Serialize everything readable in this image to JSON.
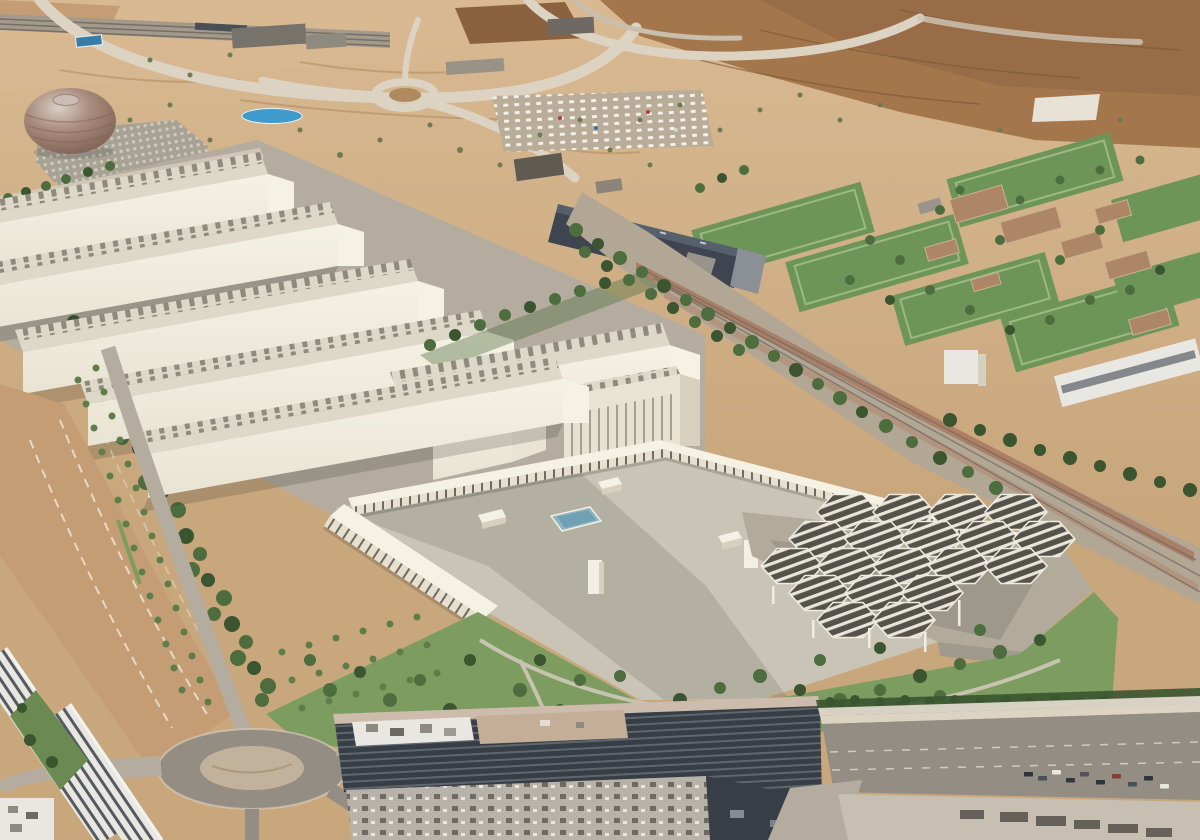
{
  "scene": {
    "title": "Aerial 3D rendering of a film-studio campus beside sports training fields",
    "soundstage_count": 5,
    "hexagon_canopy_count": 19,
    "soccer_field_count": 7
  },
  "palette": {
    "terrain-tan": "#c9a77d",
    "terrain-light": "#d8b991",
    "dirt-brown": "#c49d74",
    "hill-brown": "#a3764c",
    "hill-dark": "#8a6240",
    "road-light": "#dcd3c3",
    "road-mid": "#b5aca0",
    "asphalt": "#948d83",
    "asphalt-dark": "#7b746b",
    "rail-gray": "#b2a695",
    "ballast-red": "#a5715a",
    "cream": "#e9e3d3",
    "cream-bright": "#f5f1e3",
    "cream-shadow": "#d7d0bd",
    "roof-light": "#ddd8c8",
    "skylight-dark": "#8f8a7d",
    "plaza": "#c9c4b5",
    "plaza-dark": "#b2ab9c",
    "pool-blue": "#8fb5c3",
    "pool-deep": "#6fa0b4",
    "pond-blue": "#3f9bcc",
    "grass": "#7c9c60",
    "grass-dark": "#6a8a52",
    "field-green": "#6e9558",
    "field-light": "#9cb883",
    "tree-green": "#4e6d3e",
    "tree-mid": "#5f7d4a",
    "tree-dark": "#3a5530",
    "slab-dark": "#3e4450",
    "slab-light": "#8b9097",
    "white-bld": "#e9e7e2",
    "louver-dark": "#383e45",
    "louver-light": "#5f666e",
    "clubhouse-tan": "#ad8765",
    "dome-hi": "#d9cec4",
    "dome-mid": "#a98b7c",
    "dome-dark": "#7e6053",
    "ink-shadow": "#32302a"
  }
}
